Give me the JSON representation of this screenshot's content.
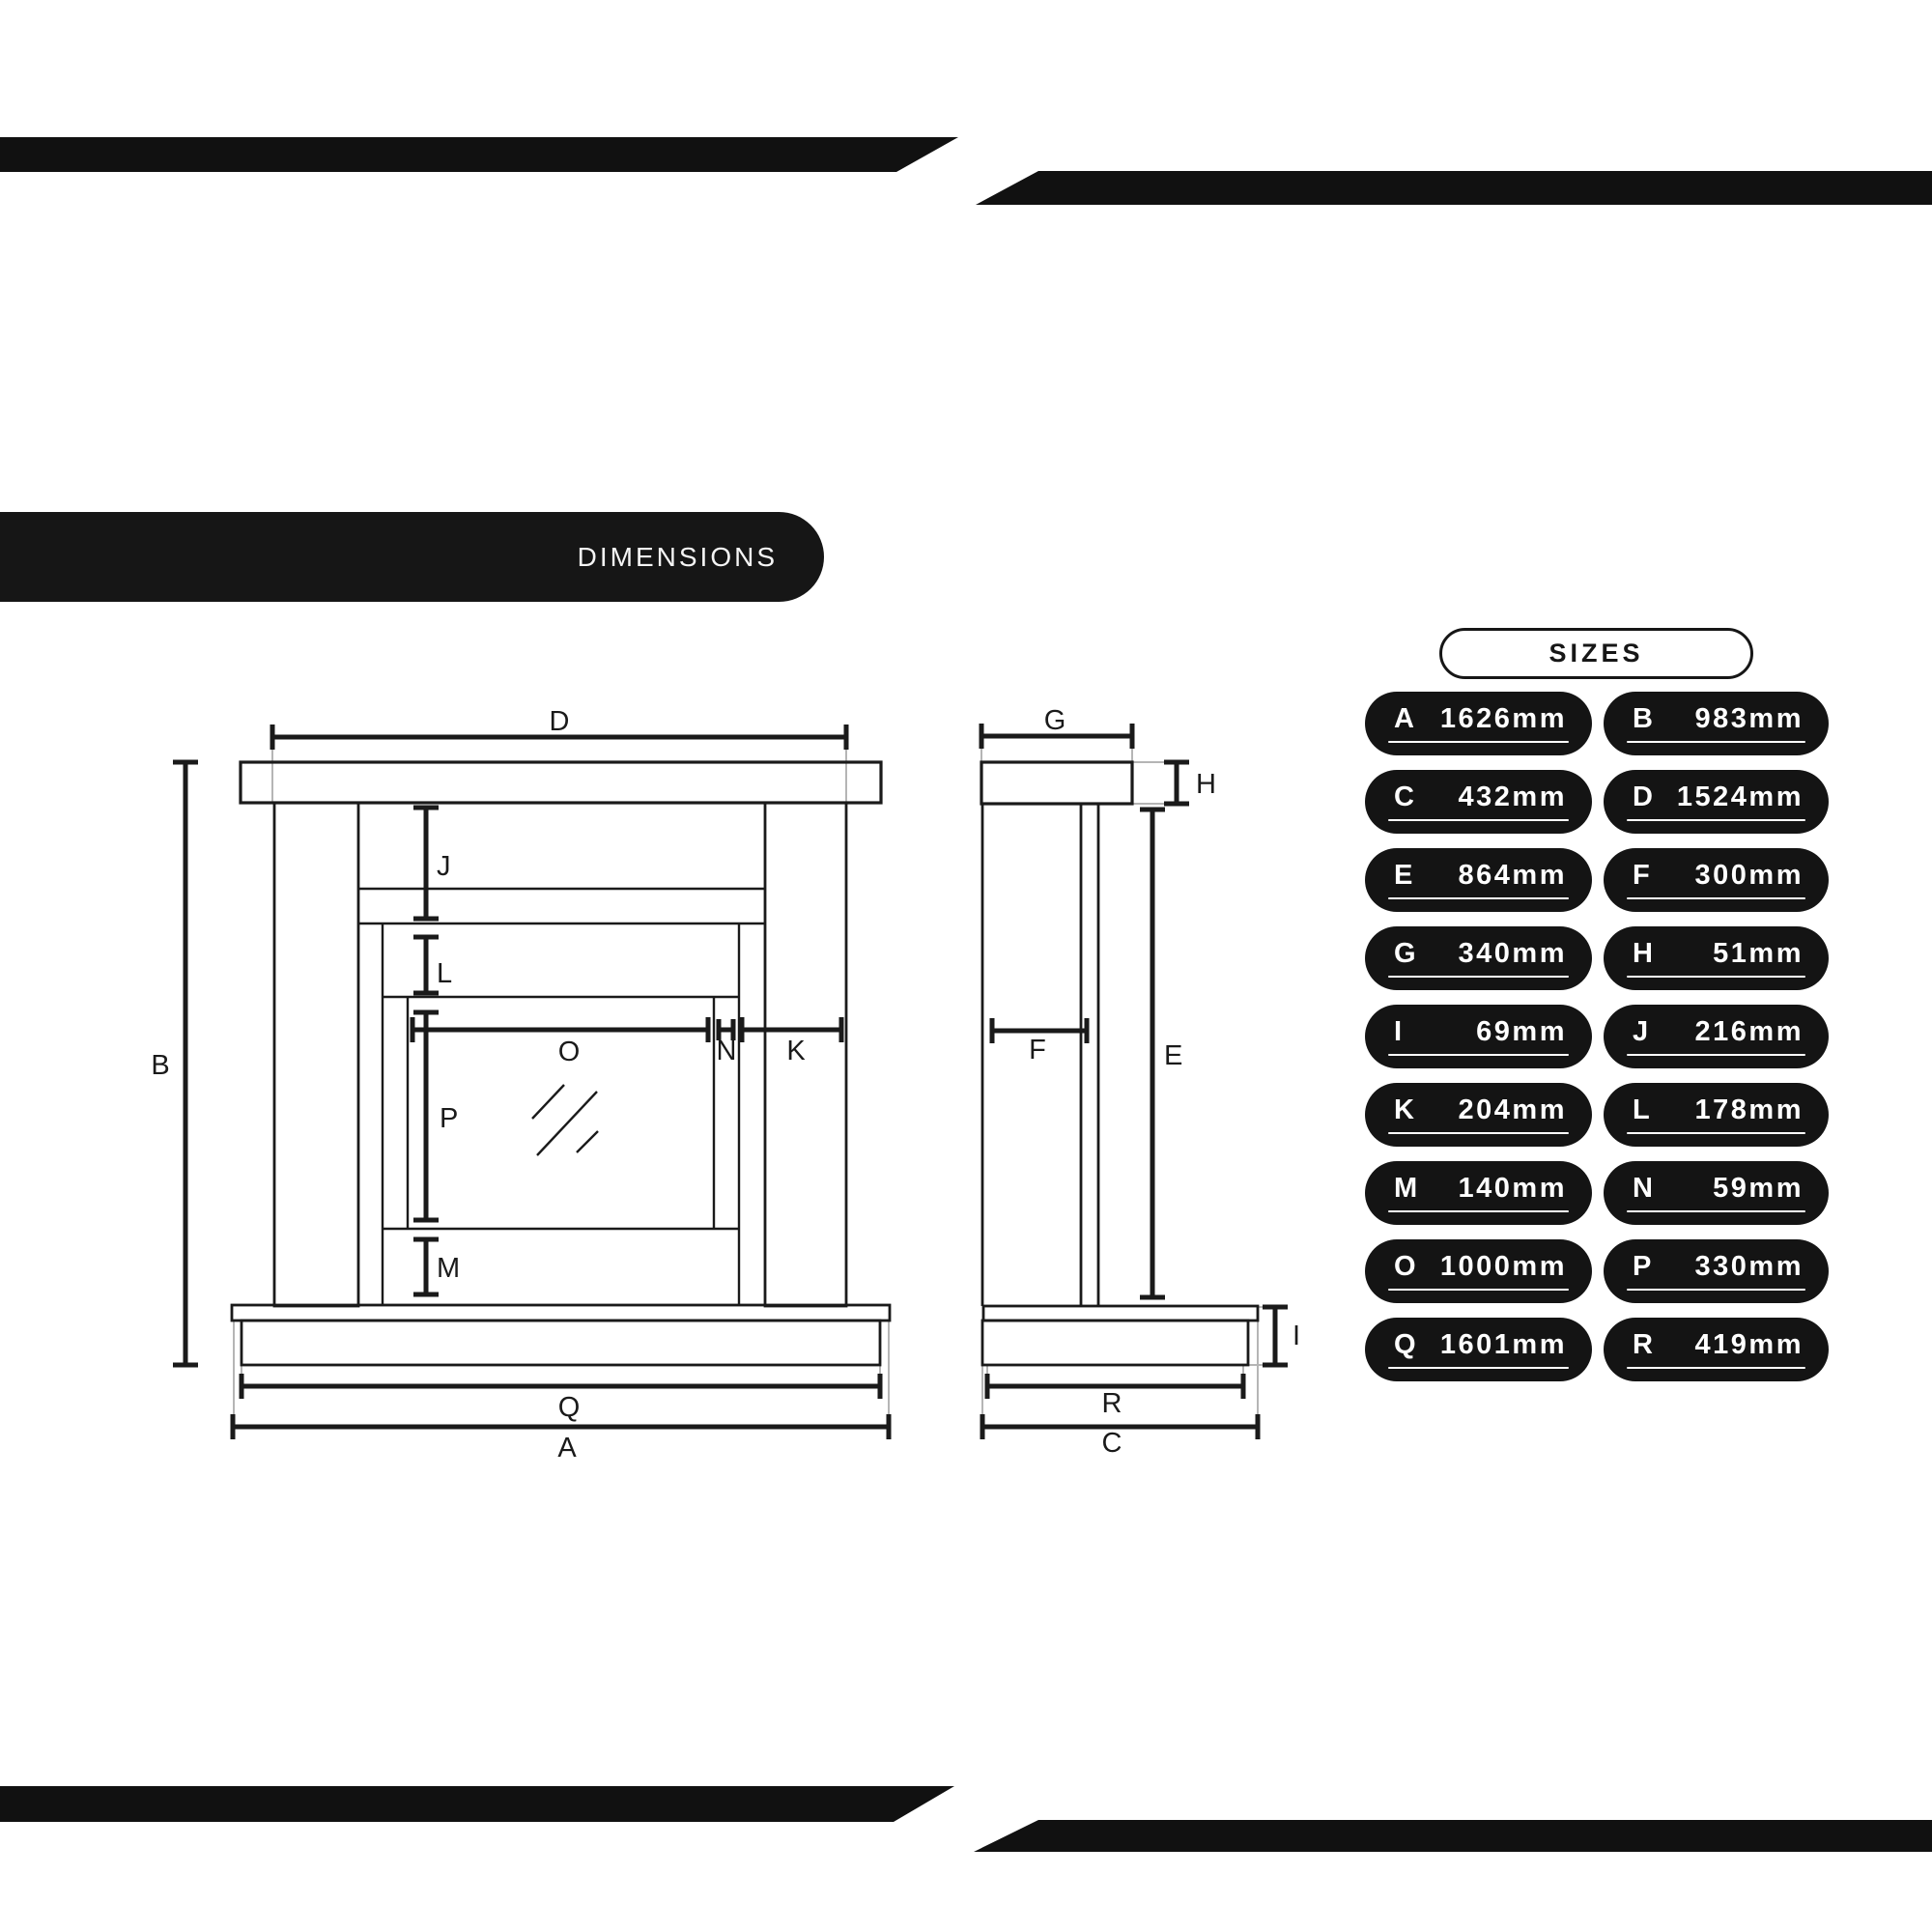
{
  "decor": {
    "bar_color": "#111111"
  },
  "dimensions_badge": {
    "label": "DIMENSIONS",
    "bg": "#161616",
    "text_color": "#f5f5f5"
  },
  "sizes_panel": {
    "title": "SIZES",
    "pill_bg": "#141414",
    "pill_text_color": "#ffffff",
    "rows": [
      {
        "letter": "A",
        "value": "1626mm"
      },
      {
        "letter": "B",
        "value": "983mm"
      },
      {
        "letter": "C",
        "value": "432mm"
      },
      {
        "letter": "D",
        "value": "1524mm"
      },
      {
        "letter": "E",
        "value": "864mm"
      },
      {
        "letter": "F",
        "value": "300mm"
      },
      {
        "letter": "G",
        "value": "340mm"
      },
      {
        "letter": "H",
        "value": "51mm"
      },
      {
        "letter": "I",
        "value": "69mm"
      },
      {
        "letter": "J",
        "value": "216mm"
      },
      {
        "letter": "K",
        "value": "204mm"
      },
      {
        "letter": "L",
        "value": "178mm"
      },
      {
        "letter": "M",
        "value": "140mm"
      },
      {
        "letter": "N",
        "value": "59mm"
      },
      {
        "letter": "O",
        "value": "1000mm"
      },
      {
        "letter": "P",
        "value": "330mm"
      },
      {
        "letter": "Q",
        "value": "1601mm"
      },
      {
        "letter": "R",
        "value": "419mm"
      }
    ]
  },
  "diagram": {
    "ink": "#1a1a1a",
    "extension_color": "#b5b5b5",
    "front_view": {
      "labels": {
        "D": "D",
        "B": "B",
        "J": "J",
        "L": "L",
        "P": "P",
        "M": "M",
        "O": "O",
        "N": "N",
        "K": "K",
        "Q": "Q",
        "A": "A"
      }
    },
    "side_view": {
      "labels": {
        "G": "G",
        "H": "H",
        "F": "F",
        "E": "E",
        "I": "I",
        "R": "R",
        "C": "C"
      }
    }
  }
}
